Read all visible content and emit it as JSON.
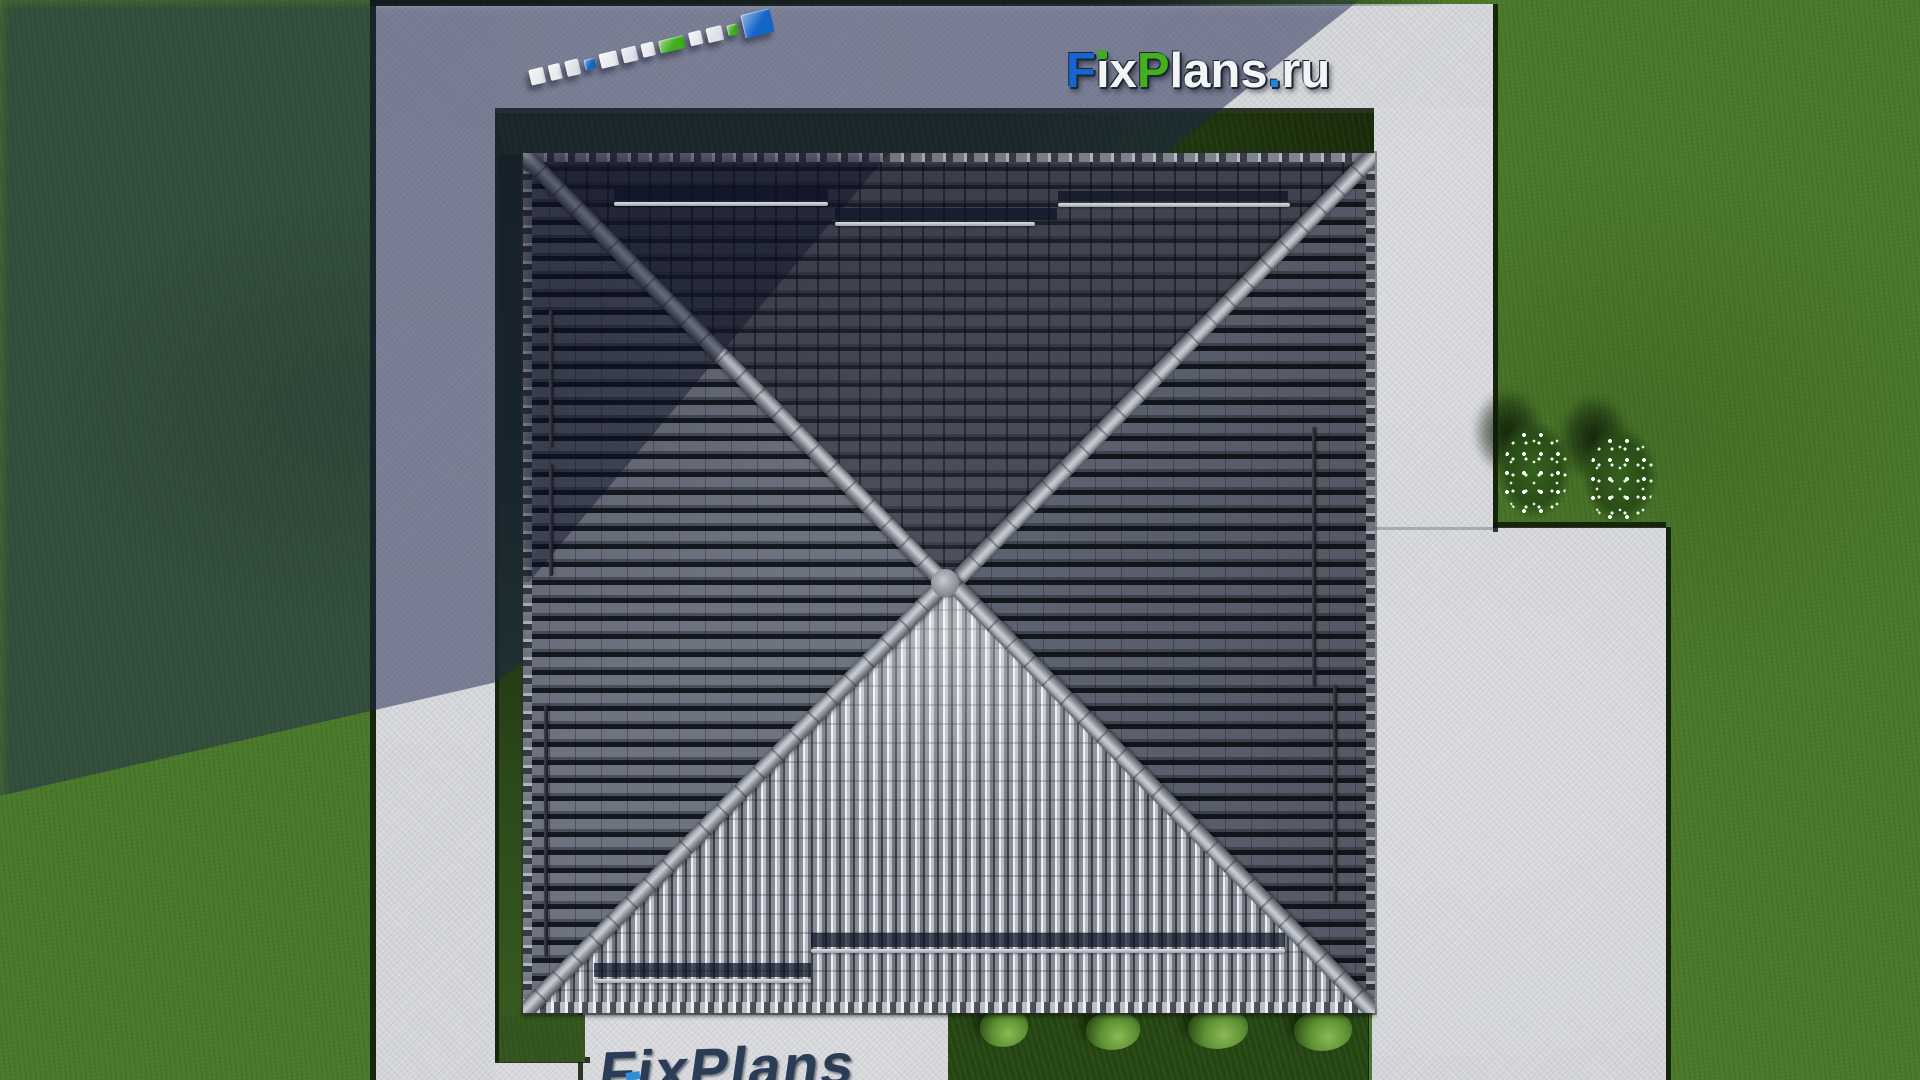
{
  "brand": {
    "name": "FixPlans.ru",
    "outline_color": "#1c2734",
    "letters": [
      {
        "ch": "F",
        "color": "#1565d2"
      },
      {
        "ch": "i",
        "color": "#f3f4f6",
        "tittle": "#3fae1e"
      },
      {
        "ch": "x",
        "color": "#f3f4f6"
      },
      {
        "ch": "P",
        "color": "#43b01c"
      },
      {
        "ch": "l",
        "color": "#f3f4f6"
      },
      {
        "ch": "a",
        "color": "#f3f4f6"
      },
      {
        "ch": "n",
        "color": "#f3f4f6"
      },
      {
        "ch": "s",
        "color": "#f3f4f6"
      },
      {
        "ch": ".",
        "color": "#1e86d6"
      },
      {
        "ch": "r",
        "color": "#f3f4f6"
      },
      {
        "ch": "u",
        "color": "#f3f4f6"
      }
    ]
  },
  "ground_marker": {
    "description": "fixplans-logo-3d-blocks-top-view",
    "blocks": [
      {
        "w": 15,
        "h": 16,
        "color": "#e9ebef"
      },
      {
        "w": 12,
        "h": 16,
        "color": "#e9ebef"
      },
      {
        "w": 14,
        "h": 16,
        "color": "#dfe2e7"
      },
      {
        "w": 11,
        "h": 11,
        "color": "#1767c8"
      },
      {
        "w": 18,
        "h": 15,
        "color": "#e9ebef"
      },
      {
        "w": 15,
        "h": 15,
        "color": "#dfe2e7"
      },
      {
        "w": 13,
        "h": 14,
        "color": "#e9ebef"
      },
      {
        "w": 26,
        "h": 13,
        "color": "#3fae1e"
      },
      {
        "w": 13,
        "h": 14,
        "color": "#e9ebef"
      },
      {
        "w": 16,
        "h": 15,
        "color": "#dfe2e7"
      },
      {
        "w": 11,
        "h": 11,
        "color": "#3fae1e"
      },
      {
        "w": 30,
        "h": 24,
        "color": "#1565c8"
      }
    ]
  },
  "bottom_watermark": {
    "text": "FixPlans",
    "color": "#2b3d56",
    "chip_color": "#2f8fd6"
  },
  "palette": {
    "grass": "#4c7a2c",
    "grass_dark": "#152609",
    "concrete": "#d3d5d9",
    "shadow": "rgba(27,35,76,0.5)",
    "roof_row_light": "#6e7380",
    "roof_row_dark": "#16181f",
    "ridge": "#b7bcc4",
    "south_tile": "#eef0f3",
    "hedge": "#254414",
    "bush": "#5c8f33",
    "flower": "#ffffff"
  }
}
